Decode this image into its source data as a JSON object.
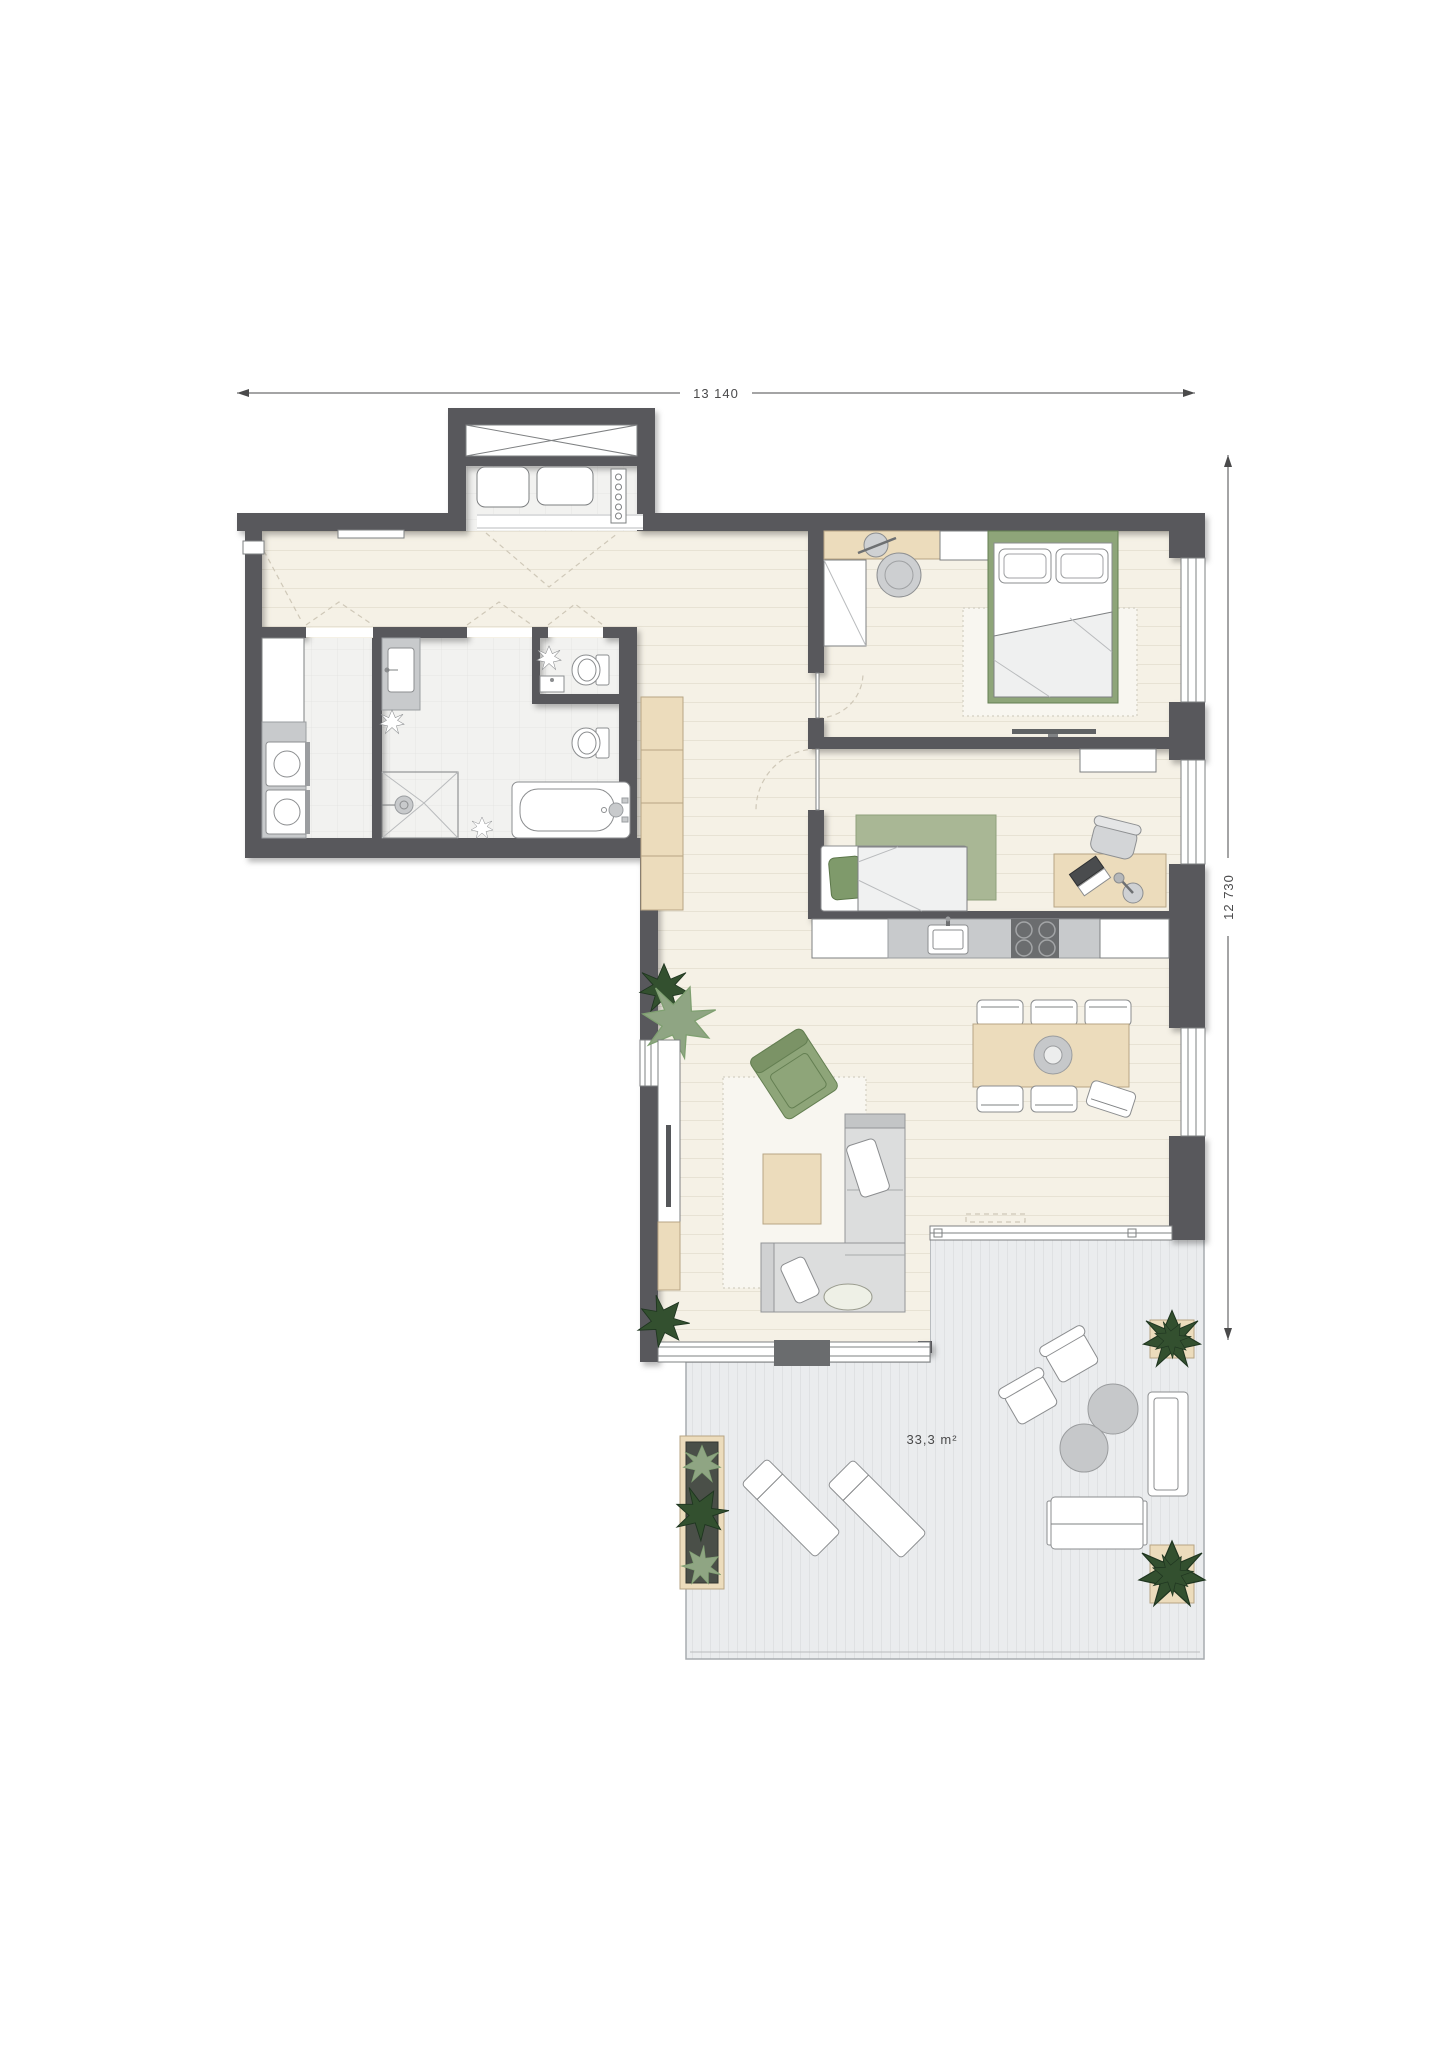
{
  "dimensions": {
    "width_label": "13 140",
    "height_label": "12 730"
  },
  "terrace": {
    "area_label": "33,3 m²"
  },
  "colors": {
    "wall": "#58595b",
    "floor_wood": "#f5f1e6",
    "floor_wood_line": "#e7e2d4",
    "floor_tile": "#f2f2f0",
    "floor_tile_line": "#e5e5e3",
    "terrace_deck": "#eaecee",
    "terrace_deck_line": "#dfe1e3",
    "terrace_border": "#a7abaf",
    "outline": "#7e8082",
    "beige": "#ecdcbc",
    "beige_dark": "#b7a584",
    "green": "#8ea579",
    "green_dark": "#647f52",
    "green_light": "#a9b795",
    "sofa_gray": "#dcdddd",
    "gray_mid": "#c8cacc",
    "stove_dark": "#6b6d6f",
    "plant_dark": "#33502f",
    "plant_light": "#8fa583",
    "dim": "#4a4a4b",
    "dash_color": "#cfc8b8"
  }
}
